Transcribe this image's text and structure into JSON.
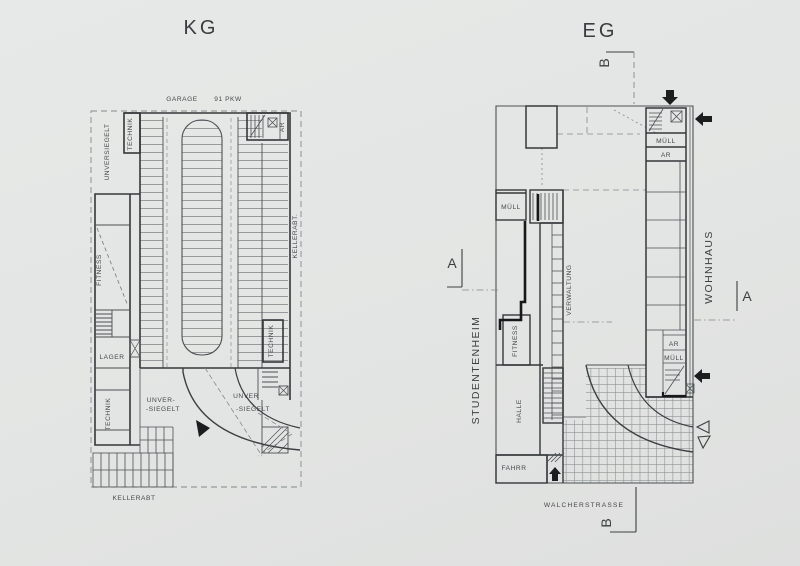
{
  "sheet": {
    "paper_color": "#e4e6e5",
    "line_color": "#4b5052",
    "wall_color": "#34383a",
    "cut_wall_color": "#161819",
    "hatch_color": "#74797b"
  },
  "kg_plan": {
    "title": "KG",
    "labels": {
      "garage": "GARAGE",
      "capacity": "91 PKW",
      "unversiegelt_top": "UNVERSIEGELT",
      "technik_top": "TECHNIK",
      "ar_top": "AR",
      "kellerabt_right": "KELLERABT.",
      "fitness": "FITNESS",
      "lager": "LAGER",
      "technik_right": "TECHNIK",
      "technik_bottom": "TECHNIK",
      "unversiegelt_mid_line1": "UNVER-",
      "unversiegelt_mid_line2": "-SIEGELT",
      "unversiegelt_right_line1": "UNVER",
      "unversiegelt_right_line2": "-SIEGELT",
      "kellerabt_bottom": "KELLERABT"
    }
  },
  "eg_plan": {
    "title": "EG",
    "labels": {
      "muell_top": "MÜLL",
      "ar_top": "AR",
      "wohnhaus": "WOHNHAUS",
      "muell_left": "MÜLL",
      "verwaltung": "VERWALTUNG",
      "fitness": "FITNESS",
      "studentenheim": "STUDENTENHEIM",
      "halle": "HALLE",
      "fahrr": "FAHRR",
      "ar_bottom": "AR",
      "muell_bottom": "MÜLL",
      "street": "WALCHERSTRASSE"
    },
    "section_markers": {
      "b_top": "B",
      "b_bottom": "B",
      "a_left": "A",
      "a_right": "A"
    }
  }
}
